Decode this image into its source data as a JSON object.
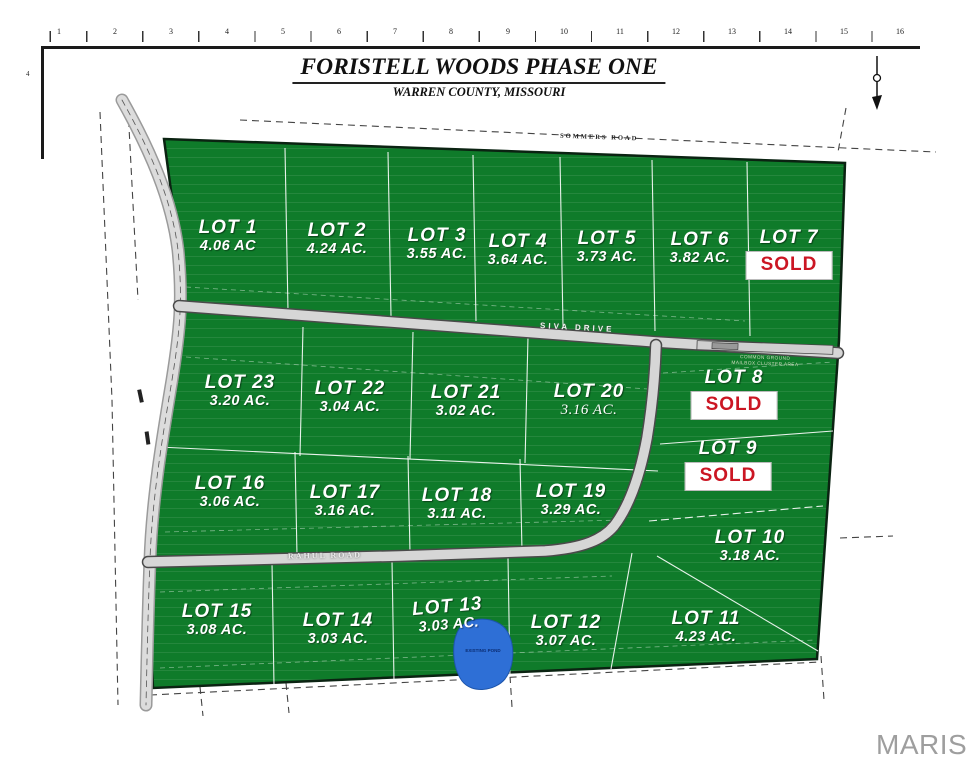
{
  "title": {
    "main": "FORISTELL WOODS PHASE ONE",
    "subtitle": "WARREN COUNTY, MISSOURI"
  },
  "ruler": {
    "numbers": [
      "1",
      "2",
      "3",
      "4",
      "5",
      "6",
      "7",
      "8",
      "9",
      "10",
      "11",
      "12",
      "13",
      "14",
      "15",
      "16"
    ],
    "left_tick": "4"
  },
  "roads": {
    "sommers": "SOMMERS ROAD",
    "siva": "SIVA DRIVE",
    "rahul": "RAHUL ROAD"
  },
  "common_area_note": {
    "line1": "COMMON GROUND",
    "line2": "MAILBOX CLUSTER AREA"
  },
  "pond_label": "EXISTING POND",
  "watermark": "MARIS",
  "colors": {
    "parcel_green": "#0f7b2a",
    "sold_red": "#cb1623",
    "road_gray": "#d6d6d6",
    "pond_blue": "#2e6fd6",
    "watermark_gray": "#9e9e9e"
  },
  "lots": [
    {
      "name": "LOT 1",
      "acreage": "4.06 AC"
    },
    {
      "name": "LOT 2",
      "acreage": "4.24 AC."
    },
    {
      "name": "LOT 3",
      "acreage": "3.55 AC."
    },
    {
      "name": "LOT 4",
      "acreage": "3.64 AC."
    },
    {
      "name": "LOT 5",
      "acreage": "3.73 AC."
    },
    {
      "name": "LOT 6",
      "acreage": "3.82 AC."
    },
    {
      "name": "LOT 7",
      "status": "SOLD"
    },
    {
      "name": "LOT 8",
      "status": "SOLD"
    },
    {
      "name": "LOT 9",
      "status": "SOLD"
    },
    {
      "name": "LOT 10",
      "acreage": "3.18 AC."
    },
    {
      "name": "LOT 11",
      "acreage": "4.23 AC."
    },
    {
      "name": "LOT 12",
      "acreage": "3.07 AC."
    },
    {
      "name": "LOT 13",
      "acreage": "3.03 AC."
    },
    {
      "name": "LOT 14",
      "acreage": "3.03 AC."
    },
    {
      "name": "LOT 15",
      "acreage": "3.08 AC."
    },
    {
      "name": "LOT 16",
      "acreage": "3.06 AC."
    },
    {
      "name": "LOT 17",
      "acreage": "3.16 AC."
    },
    {
      "name": "LOT 18",
      "acreage": "3.11 AC."
    },
    {
      "name": "LOT 19",
      "acreage": "3.29 AC."
    },
    {
      "name": "LOT 20",
      "acreage": "3.16 AC."
    },
    {
      "name": "LOT 21",
      "acreage": "3.02 AC."
    },
    {
      "name": "LOT 22",
      "acreage": "3.04 AC."
    },
    {
      "name": "LOT 23",
      "acreage": "3.20 AC."
    }
  ]
}
